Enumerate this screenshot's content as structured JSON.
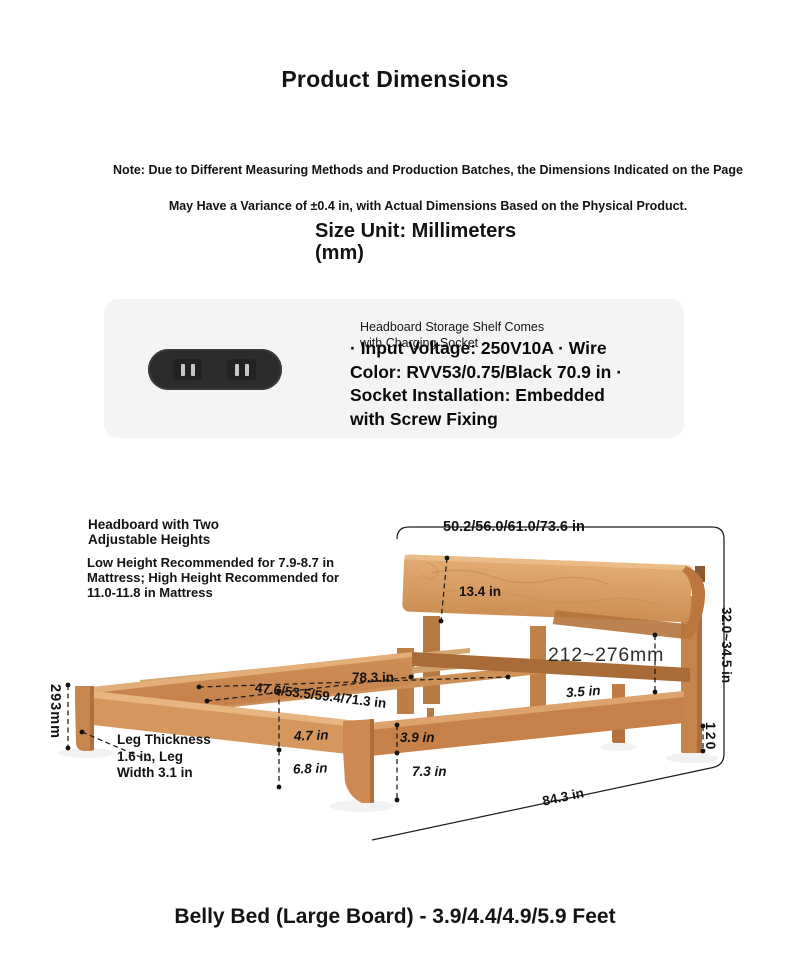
{
  "header": {
    "title": "Product Dimensions"
  },
  "note": {
    "lines": [
      "Note: Due to Different Measuring Methods and Production Batches, the Dimensions Indicated on the Page",
      "May Have a Variance of ±0.4 in, with Actual Dimensions Based on the Physical Product."
    ]
  },
  "size_unit": {
    "lines": [
      "Size Unit: Millimeters",
      "(mm)"
    ]
  },
  "socket_card": {
    "bg_color": "#f4f4f4",
    "socket_color": "#2c2c2e",
    "caption_lines": [
      "Headboard Storage Shelf Comes",
      "with Charging Socket"
    ],
    "spec_lines": [
      "· Input Voltage: 250V10A · Wire",
      "Color: RVV53/0.75/Black 70.9 in ·",
      "Socket Installation: Embedded",
      "with Screw Fixing"
    ]
  },
  "diagram": {
    "wood_color": "#d19a63",
    "line_color": "#1b1b1b",
    "headboard_note": {
      "title_lines": [
        "Headboard with Two",
        "Adjustable Heights"
      ],
      "body_lines": [
        "Low Height Recommended for 7.9-8.7 in",
        "Mattress; High Height Recommended for",
        "11.0-11.8 in Mattress"
      ]
    },
    "leg_note_lines": [
      "Leg Thickness",
      "1.6 in, Leg",
      "Width 3.1 in"
    ],
    "dimensions": {
      "width_top": "50.2/56.0/61.0/73.6 in",
      "headboard_height": "13.4 in",
      "headboard_gap": "212~276mm",
      "total_height": "32.0~34.5 in",
      "length_top": "78.3 in",
      "width_inner": "47.6/53.5/59.4/71.3 in",
      "side_rail": "3.5 in",
      "frame_front": "4.7 in",
      "clearance_front": "6.8 in",
      "center_rail": "3.9 in",
      "clearance_center": "7.3 in",
      "length_outer": "84.3 in",
      "frame_height": "293mm",
      "leg_height": "120"
    }
  },
  "footer": {
    "title": "Belly Bed (Large Board) - 3.9/4.4/4.9/5.9 Feet"
  }
}
